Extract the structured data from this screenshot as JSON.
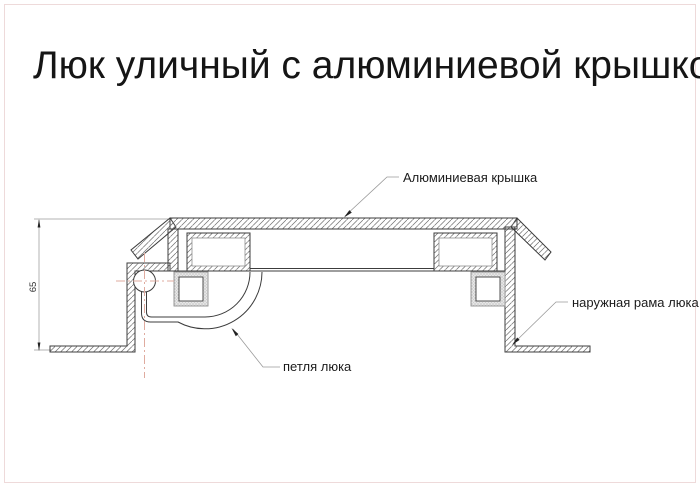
{
  "title": "Люк уличный с алюминиевой крышкой",
  "labels": {
    "cover": "Алюминиевая крышка",
    "frame": "наружная рама люка",
    "hinge": "петля люка"
  },
  "dimension": {
    "height": "65"
  },
  "colors": {
    "outline": "#3c3c3c",
    "hatch": "#6e6e6e",
    "leader": "#9a9a9a",
    "centerline": "#dfab9f",
    "page_border": "#eedada"
  }
}
